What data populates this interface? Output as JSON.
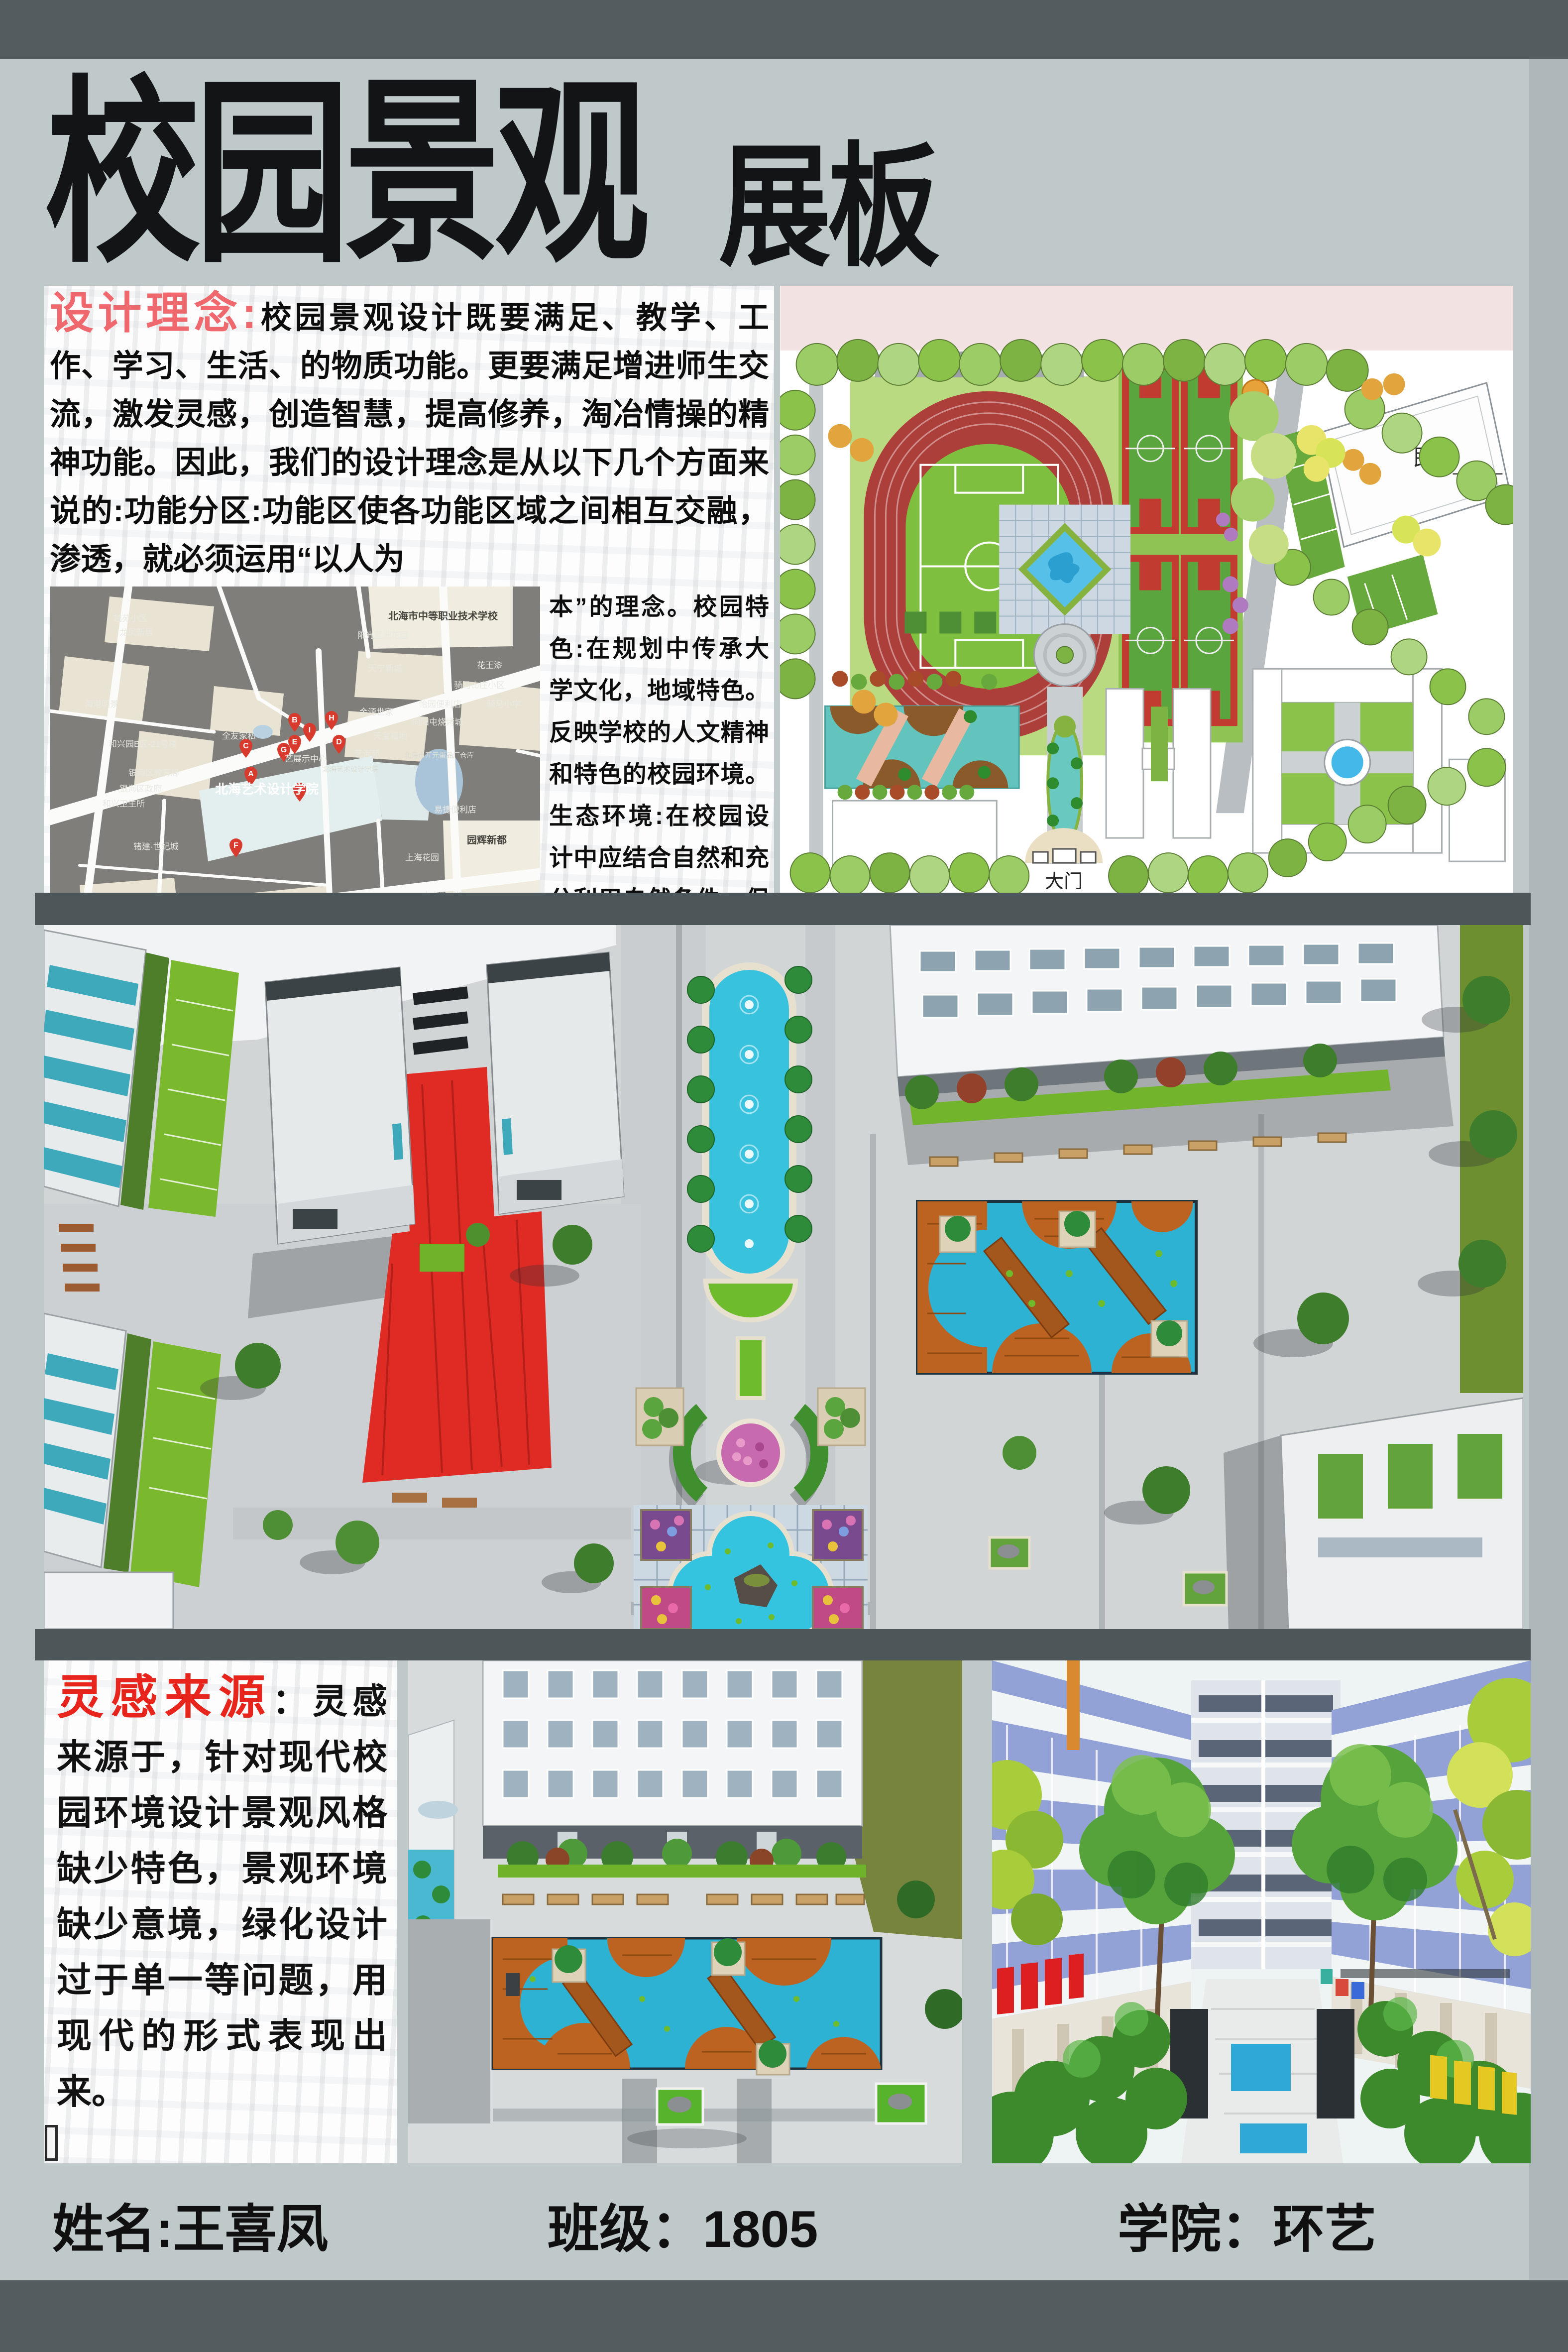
{
  "title": {
    "main": "校园景观",
    "suffix": "展板"
  },
  "concept": {
    "heading": "设计理念",
    "separator": ":",
    "intro": "校园景观设计既要满足、教学、工作、学习、生活、的物质功能。更要满足增进师生交流，激发灵感，创造智慧，提高修养，淘冶情操的精神功能。因此，我们的设计理念是从以下几个方面来说的:功能分区:功能区使各功能区域之间相互交融，渗透，就必须运用“以人为",
    "side": "本”的理念。校园特色:在规划中传承大学文化，地域特色。反映学校的人文精神和特色的校园环境。生态环境:在校园设计中应结合自然和充分利用自然条件，保护和构建校园的生态系统。"
  },
  "map": {
    "pins": [
      "A",
      "B",
      "C",
      "D",
      "E",
      "F",
      "G",
      "H",
      "I",
      "J"
    ],
    "labels": [
      "北海市中等职业技术学校",
      "阳光蓝洲花园",
      "天宁新城",
      "花王漆",
      "骑马山庄小区",
      "骑马小学",
      "怡园便利店",
      "向阳屯烧烤城",
      "金源世家",
      "天宝福地",
      "艺海苑",
      "北海市开元蛋品厂仓库",
      "易捷便利店",
      "园辉新都",
      "上海花园",
      "大山现代城",
      "北海市人民检察院",
      "北海艺术设计学院",
      "艺展示中心",
      "银海区教育局",
      "银海区政府",
      "和兴卫生所",
      "和兴园B区-21号楼",
      "全友家私",
      "锗建·世纪城",
      "海港明景",
      "越苑小区",
      "龙凤新居",
      "海岸华府",
      "恒宇海岸华府-二区",
      "银投乾坤国际城",
      "和兴小学",
      "深海花园",
      "农村商业银行",
      "中国民间博物馆",
      "北海艺术设计学院"
    ]
  },
  "master_plan": {
    "residence": "民宅",
    "gate": "大门"
  },
  "inspiration": {
    "heading": "灵感来源",
    "separator": "：",
    "body": "灵感来源于，针对现代校园环境设计景观风格缺少特色，景观环境缺少意境，绿化设计过于单一等问题，用现代的形式表现出来。"
  },
  "footer": {
    "name": "姓名:王喜凤",
    "class_label": "班级：1805",
    "college": "学院：环艺"
  },
  "colors": {
    "band_dark": "#535c5f",
    "page_bg": "#bfc9ca",
    "accent_red_soft": "#ef686e",
    "accent_red": "#e7251c",
    "map_bg": "#7f7e7a",
    "plan_pink": "#f3e2e2",
    "water_teal": "#35c0dc",
    "deck_orange": "#bc6322",
    "lawn_green": "#76b82e",
    "track_red": "#ad3f3b",
    "plaza_red": "#e02b25"
  }
}
